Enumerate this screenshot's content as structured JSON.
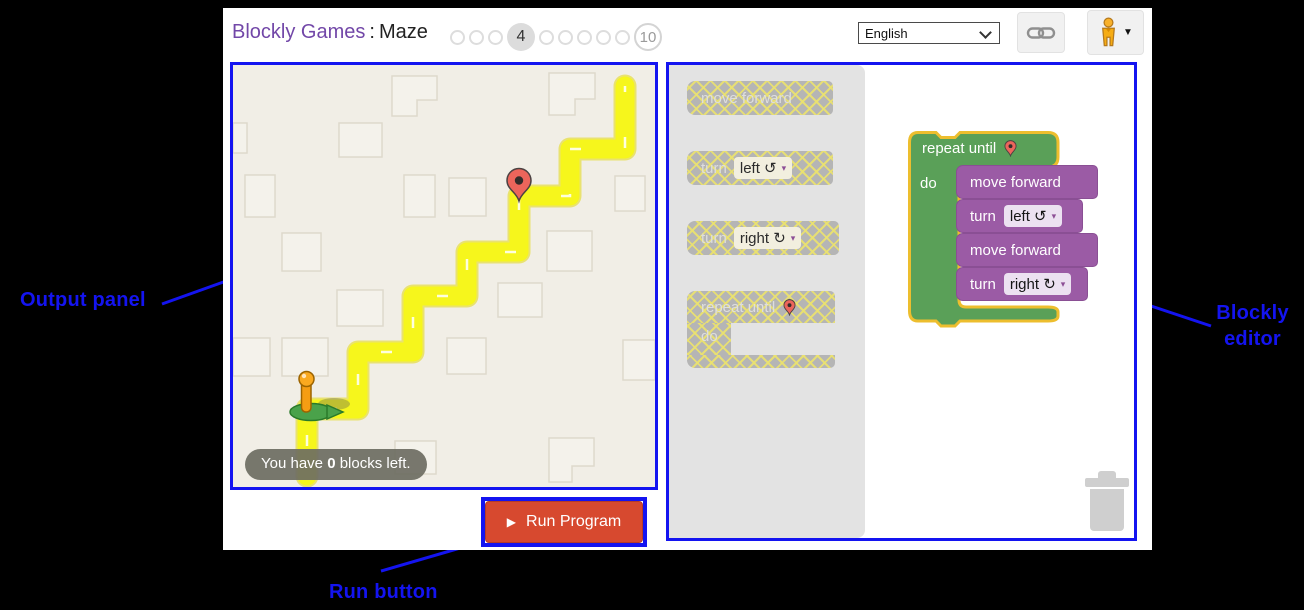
{
  "header": {
    "brand": "Blockly Games",
    "separator": ":",
    "game": "Maze",
    "levels": {
      "current_label": "4",
      "final_label": "10"
    },
    "language_value": "English"
  },
  "maze": {
    "tooltip_prefix": "You have ",
    "tooltip_count": "0",
    "tooltip_suffix": " blocks left."
  },
  "toolbox": {
    "blocks": [
      {
        "label": "move forward"
      },
      {
        "label": "turn",
        "field": "left ↺"
      },
      {
        "label": "turn",
        "field": "right ↻"
      },
      {
        "label": "repeat until",
        "sub": "do"
      }
    ]
  },
  "workspace": {
    "repeat_label": "repeat until",
    "do_label": "do",
    "stack": [
      {
        "label": "move forward"
      },
      {
        "label": "turn",
        "field": "left ↺"
      },
      {
        "label": "move forward"
      },
      {
        "label": "turn",
        "field": "right ↻"
      }
    ]
  },
  "run_button": {
    "label": "Run Program"
  },
  "annotations": {
    "output": "Output panel",
    "editor_line1": "Blockly",
    "editor_line2": "editor",
    "run": "Run button"
  },
  "colors": {
    "annotation_blue": "#1414f0",
    "brand_purple": "#7247a8",
    "maze_background": "#f1eee6",
    "path_yellow": "#f6f61c",
    "block_green": "#5aa058",
    "block_purple": "#9b5ba5",
    "selection_gold": "#edbe2e",
    "disabled_gray": "#b5b5b5",
    "run_red": "#d7492f"
  }
}
